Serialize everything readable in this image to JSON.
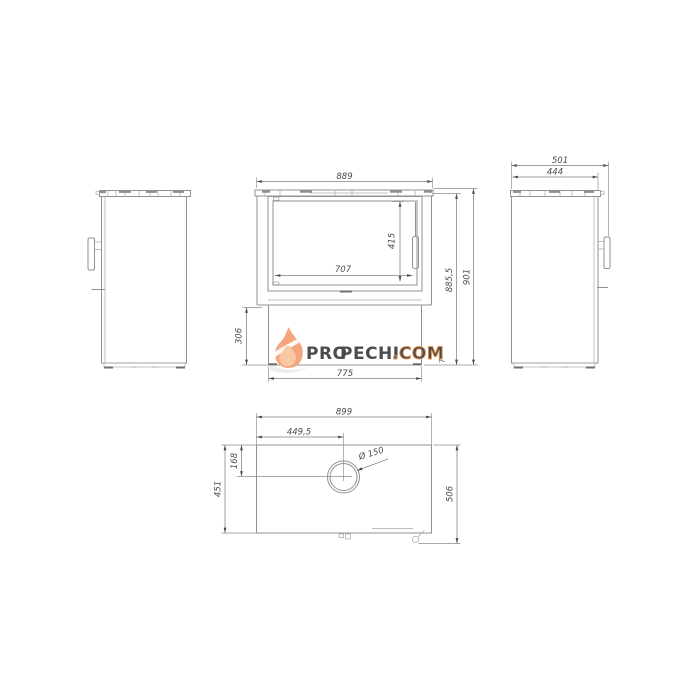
{
  "title": "stove-technical-drawing",
  "watermark": {
    "pro": "PRO",
    "pechi": "PECHI",
    "com": ".COM"
  },
  "front_view": {
    "width": "889",
    "glass_height": "415",
    "glass_width": "707",
    "plinth_height": "306",
    "plinth_width": "775",
    "height_without_top": "885,5",
    "height_total": "901",
    "foot_gap": "7"
  },
  "right_view": {
    "depth_total": "501",
    "depth_body": "444"
  },
  "top_view": {
    "width": "899",
    "flue_offset_x": "449,5",
    "flue_offset_y": "168",
    "depth_body": "451",
    "depth_total": "506",
    "flue_diameter": "Ø 150"
  },
  "colors": {
    "accent_orange": "#e9914f",
    "brand_dark": "#51565b",
    "flame_light": "#f3a57e",
    "flame_inner": "#f9c9a5",
    "line_gray": "#8a8a8a"
  }
}
